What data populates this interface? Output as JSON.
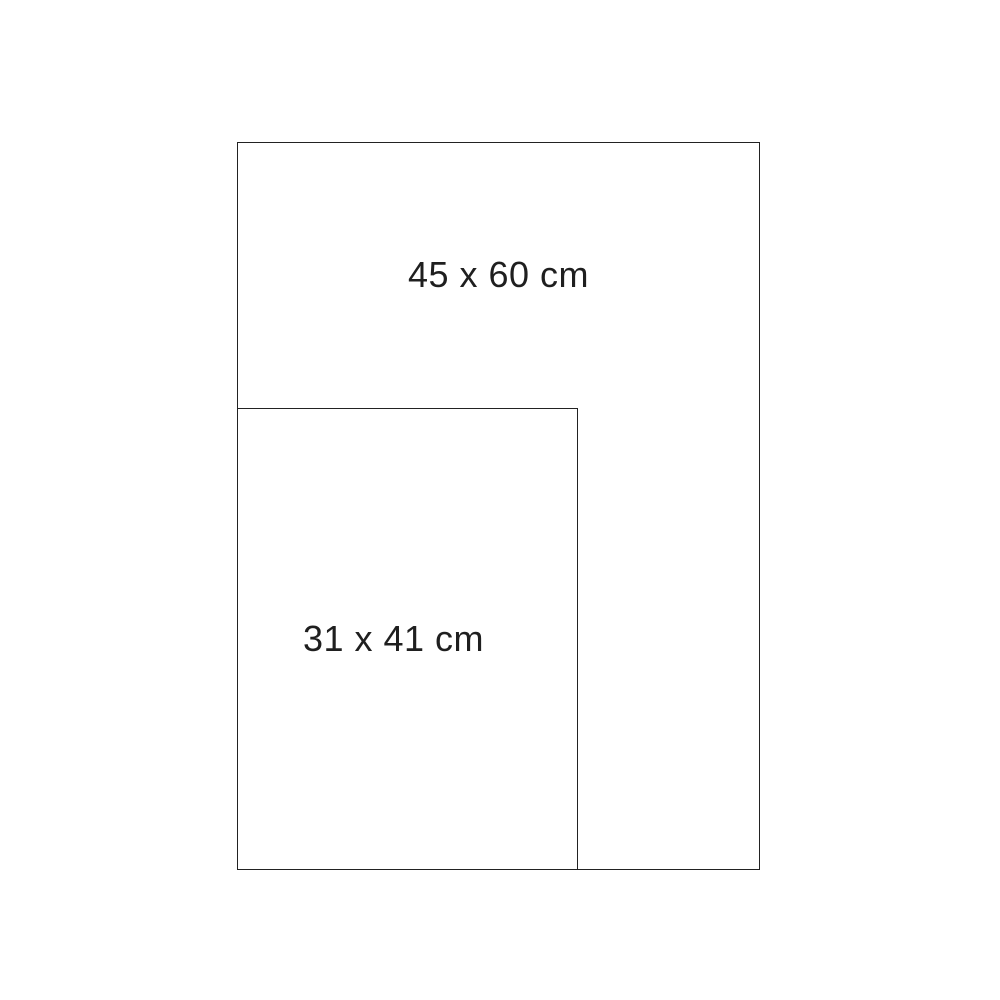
{
  "diagram": {
    "kind": "size-comparison",
    "background_color": "#ffffff",
    "line_color": "#222222",
    "text_color": "#1f1f1f",
    "rectangles": [
      {
        "label": "45 x 60 cm",
        "width_cm": 45,
        "height_cm": 60
      },
      {
        "label": "31 x 41 cm",
        "width_cm": 31,
        "height_cm": 41
      }
    ]
  }
}
